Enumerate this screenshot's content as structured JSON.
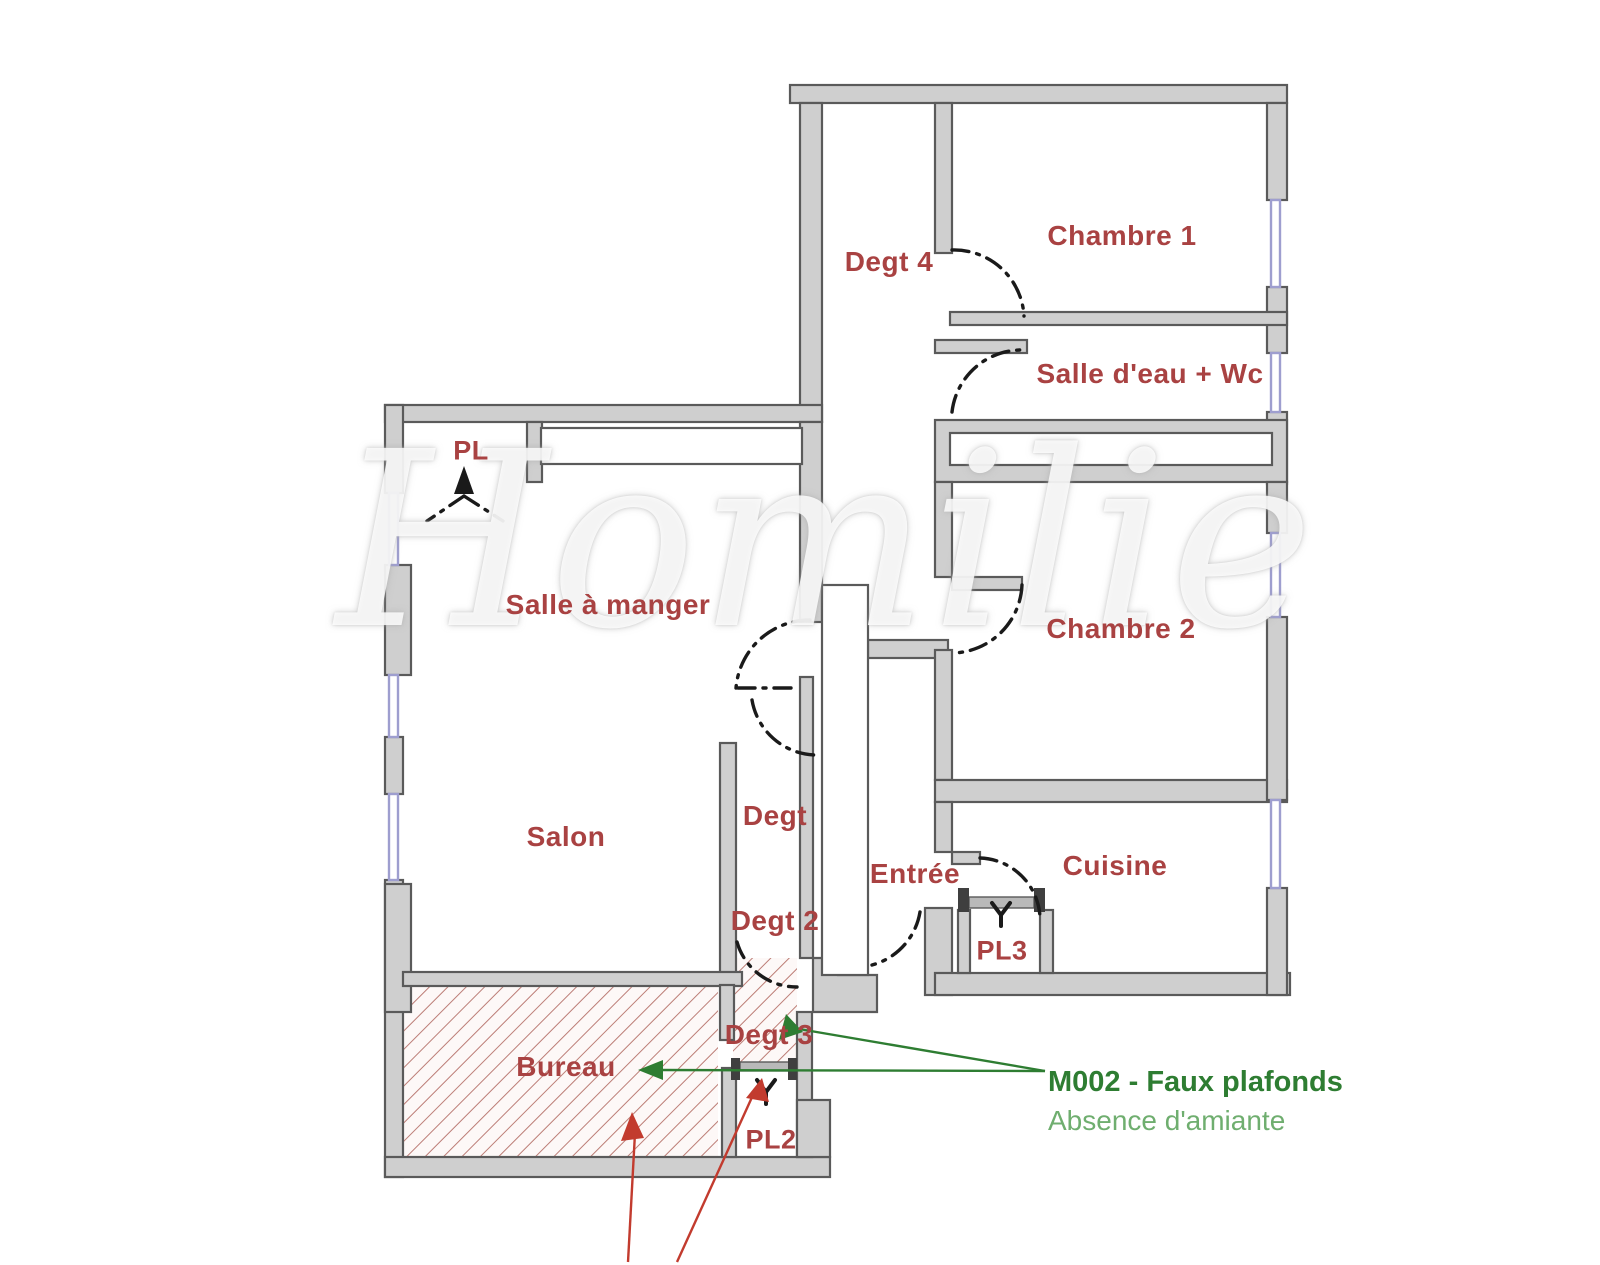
{
  "watermark": "Homilie",
  "rooms": [
    {
      "id": "pl",
      "label": "PL"
    },
    {
      "id": "salle-a-manger",
      "label": "Salle à manger"
    },
    {
      "id": "degt4",
      "label": "Degt 4"
    },
    {
      "id": "chambre1",
      "label": "Chambre 1"
    },
    {
      "id": "salle-eau-wc",
      "label": "Salle d'eau + Wc"
    },
    {
      "id": "chambre2",
      "label": "Chambre 2"
    },
    {
      "id": "salon",
      "label": "Salon"
    },
    {
      "id": "degt",
      "label": "Degt"
    },
    {
      "id": "degt2",
      "label": "Degt 2"
    },
    {
      "id": "entree",
      "label": "Entrée"
    },
    {
      "id": "cuisine",
      "label": "Cuisine"
    },
    {
      "id": "pl3",
      "label": "PL3"
    },
    {
      "id": "bureau",
      "label": "Bureau"
    },
    {
      "id": "degt3",
      "label": "Degt 3"
    },
    {
      "id": "pl2",
      "label": "PL2"
    }
  ],
  "annotation": {
    "measure_code": "M002 - Faux plafonds",
    "result": "Absence d'amiante"
  },
  "colors": {
    "wall_fill": "#cfcfcf",
    "wall_stroke": "#5a5a5a",
    "window_color": "#9e9ecf",
    "hatch_line": "#bc7d76",
    "hatch_bg": "#fdf8f7",
    "label_red": "#a94242",
    "door_color": "#1a1a1a",
    "green_dark": "#2e7d32",
    "green_light": "#6fae6f",
    "arrow_red": "#c23b2e"
  }
}
